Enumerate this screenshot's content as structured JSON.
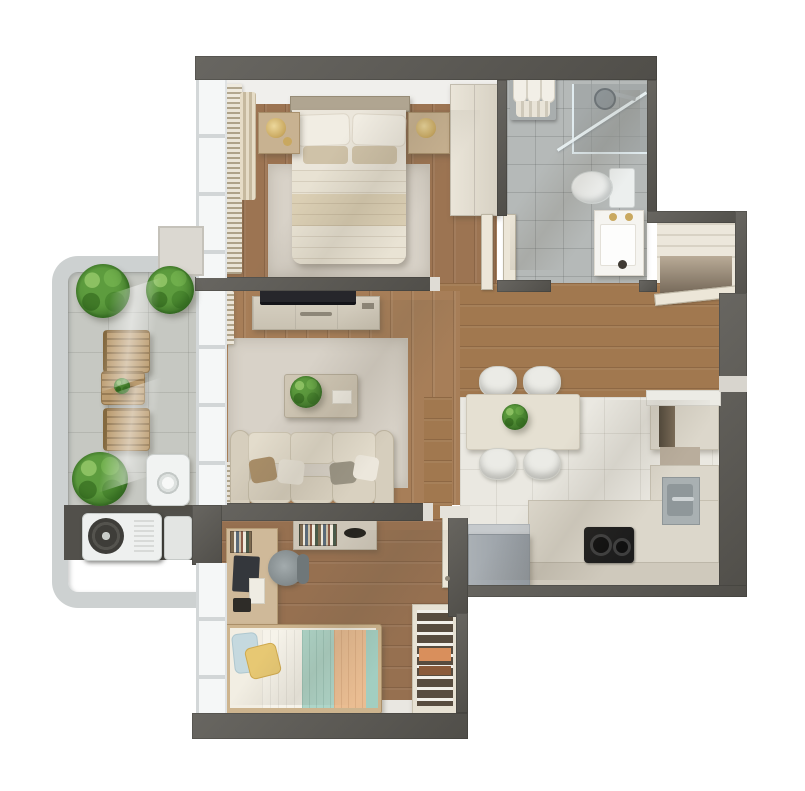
{
  "scene": {
    "type": "3d-floor-plan-render",
    "view": "top-down",
    "background": "#ffffff",
    "description": "Photorealistic top-down 3D render of a one-bedroom apartment floor plan with master bedroom, bathroom, entry closet, open living-dining area, kitchen, kids bedroom, balcony and AC niche"
  },
  "palette": {
    "wall_dark": "#5b5954",
    "wood_floor": "#9c7452",
    "wood_floor_light": "#a77e58",
    "kitchen_tile": "#eae8e1",
    "bathroom_tile": "#b5b9b8",
    "balcony_concrete": "#c6c8c2",
    "outer_wall_light": "#cdd1d1",
    "cabinet_cream": "#dcd7cb",
    "fabric_beige": "#ddd6c7",
    "plant_green": "#55923a",
    "accent_gold": "#c9a85f",
    "kids_teal": "#aed5c8",
    "kids_peach": "#eabd92",
    "kids_yellow": "#e7c873",
    "kids_blue": "#c5d9df",
    "appliance_gray": "#a5abb1"
  },
  "rooms": [
    {
      "name": "master-bedroom",
      "label": "Master bedroom",
      "furniture": [
        "double bed",
        "headboard",
        "4 pillows",
        "duvet",
        "area rug",
        "left nightstand",
        "right nightstand",
        "2 gold table lamps",
        "wardrobe",
        "window blinds",
        "curtain"
      ]
    },
    {
      "name": "bathroom",
      "label": "Bathroom",
      "furniture": [
        "glass shower enclosure",
        "shower head",
        "toilet",
        "vanity with sink",
        "gold faucet",
        "towel rack with rolled towels",
        "open door"
      ]
    },
    {
      "name": "entry-closet",
      "label": "Entry closet",
      "furniture": [
        "shelving",
        "open entry door"
      ]
    },
    {
      "name": "living-room",
      "label": "Living room",
      "furniture": [
        "TV",
        "TV console",
        "3-seat sofa",
        "4 throw pillows",
        "coffee table",
        "potted plant",
        "tray",
        "area rug",
        "roller blinds",
        "wall shelf with books"
      ]
    },
    {
      "name": "kitchen-dining",
      "label": "Kitchen and dining",
      "furniture": [
        "dining table",
        "4 chairs",
        "table plant",
        "L-shaped counter",
        "sink",
        "chrome faucet",
        "cooktop",
        "refrigerator",
        "tall cabinet"
      ]
    },
    {
      "name": "kids-bedroom",
      "label": "Kids bedroom",
      "furniture": [
        "single bed",
        "yellow pillow",
        "blue pillow",
        "teal blanket",
        "peach blanket",
        "study desk",
        "laptop",
        "desk chair",
        "open wardrobe with clothes",
        "wall shelf with books",
        "open door"
      ]
    },
    {
      "name": "balcony",
      "label": "Balcony",
      "furniture": [
        "2 wooden lounge chairs",
        "wooden side table",
        "3 potted plants",
        "washing machine"
      ]
    },
    {
      "name": "utility-niche",
      "label": "AC niche",
      "furniture": [
        "air conditioner outdoor unit"
      ]
    }
  ]
}
